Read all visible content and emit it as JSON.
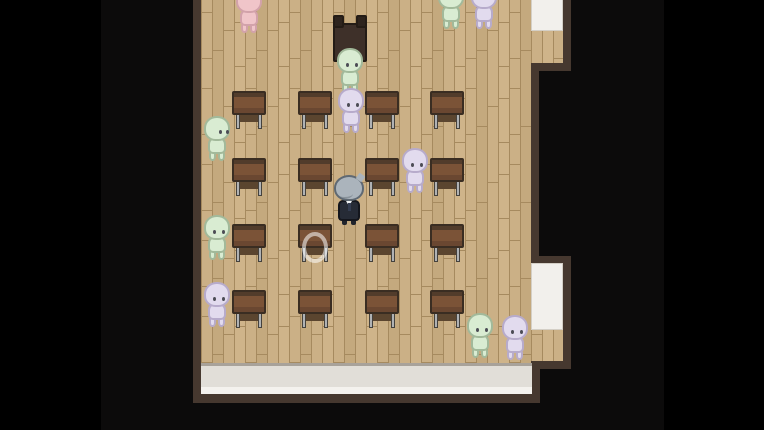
{
  "scene": {
    "name": "classroom",
    "style": "top-down-rpg"
  },
  "colors": {
    "outer": "#000000",
    "viewport": "#0c0b0b",
    "wall": "#46382f",
    "door": "#f2f0ec",
    "strip-shadow": "#a8a29a",
    "strip-main": "#e1ded8",
    "strip-light": "#f4f2ee",
    "desk-top": "#7b5337",
    "desk-edge": "#523c2b",
    "desk-outline": "#3a2d22",
    "desk-front": "#6a4731",
    "metal": "#b0b2b4",
    "metal-dark": "#45423d",
    "seat": "#5b452f",
    "podium-body": "#3e3029",
    "podium-dark": "#241c16",
    "ghost-eye": "#4c4c55",
    "hair": "#abb4bc",
    "hair-line": "#5f6973",
    "skin": "#ecdcc4",
    "suit": "#262b36",
    "suit-line": "#14161d",
    "collar": "#eff1f3",
    "floor-base": "#cbb086",
    "floor-line": "#a68a5f"
  },
  "ghost_palette": {
    "green": {
      "fill": "#d9ecd2",
      "line": "#a2b99a"
    },
    "pink": {
      "fill": "#f0c5c9",
      "line": "#d2a2aa"
    },
    "lavender": {
      "fill": "#e2dbee",
      "line": "#b7abcb"
    }
  },
  "desks": [
    {
      "x": 232,
      "y": 91
    },
    {
      "x": 298,
      "y": 91
    },
    {
      "x": 365,
      "y": 91
    },
    {
      "x": 430,
      "y": 91
    },
    {
      "x": 232,
      "y": 158
    },
    {
      "x": 298,
      "y": 158
    },
    {
      "x": 365,
      "y": 158
    },
    {
      "x": 430,
      "y": 158
    },
    {
      "x": 232,
      "y": 224
    },
    {
      "x": 298,
      "y": 224
    },
    {
      "x": 365,
      "y": 224
    },
    {
      "x": 430,
      "y": 224
    },
    {
      "x": 232,
      "y": 290
    },
    {
      "x": 298,
      "y": 290
    },
    {
      "x": 365,
      "y": 290
    },
    {
      "x": 430,
      "y": 290
    }
  ],
  "ghosts": [
    {
      "x": 438,
      "y": -16,
      "color": "green",
      "facing": "up"
    },
    {
      "x": 471,
      "y": -16,
      "color": "lavender",
      "facing": "up"
    },
    {
      "x": 236,
      "y": -12,
      "color": "pink",
      "facing": "up"
    },
    {
      "x": 337,
      "y": 48,
      "color": "green",
      "facing": "down"
    },
    {
      "x": 338,
      "y": 88,
      "color": "lavender",
      "facing": "down"
    },
    {
      "x": 204,
      "y": 116,
      "color": "green",
      "facing": "right"
    },
    {
      "x": 402,
      "y": 148,
      "color": "lavender",
      "facing": "down"
    },
    {
      "x": 204,
      "y": 215,
      "color": "green",
      "facing": "down"
    },
    {
      "x": 204,
      "y": 282,
      "color": "lavender",
      "facing": "down"
    },
    {
      "x": 467,
      "y": 313,
      "color": "green",
      "facing": "down"
    },
    {
      "x": 502,
      "y": 315,
      "color": "lavender",
      "facing": "down"
    }
  ],
  "player": {
    "x": 334,
    "y": 175
  },
  "podium": {
    "x": 333,
    "y": 15
  },
  "ring": {
    "x": 302,
    "y": 232,
    "w": 26,
    "h": 31
  }
}
